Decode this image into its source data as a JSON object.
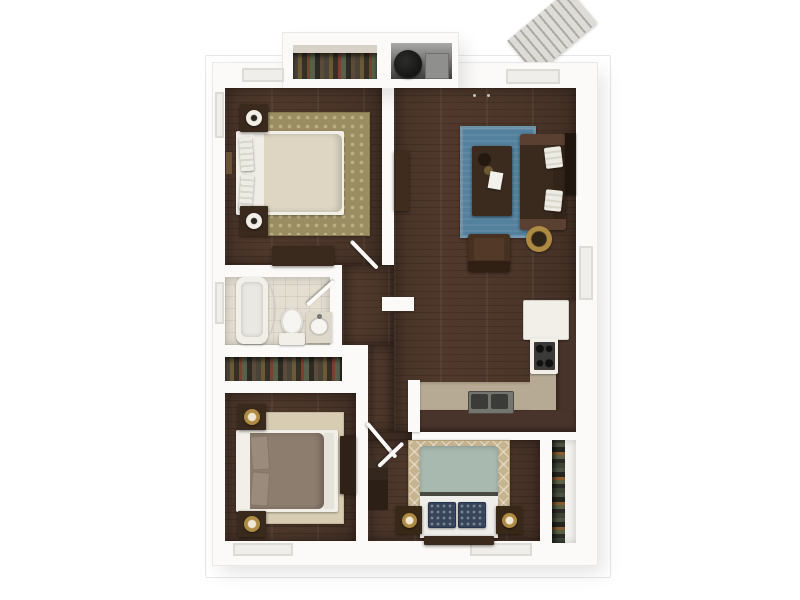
{
  "meta": {
    "type": "3d-floor-plan-rendering",
    "view": "top-down isometric",
    "visible_text": "none"
  },
  "palette": {
    "bg": "#ffffff",
    "wall": "#fbfaf8",
    "wood": "#50392c",
    "tile": "#e4ded1",
    "rugBlue": "#54819d",
    "rugOlive": "#9a8d61",
    "rugCream": "#d8cdb3",
    "rugTan": "#c6b48f",
    "duvetCream": "#ded6c3",
    "duvetTaupe": "#8d7d6e",
    "duvetSage": "#a8b9af",
    "pillowNavy": "#36455a",
    "furnDark": "#3a2a1d",
    "furnWhite": "#f1efe8",
    "lampCenter": "#2a2620",
    "counterTop": "#b7aa95",
    "counterBase": "#48342a",
    "steel": "#8f8f8d",
    "gold": "#ae8a42",
    "stairs": "#dedcd6",
    "glass": "#efeeea"
  },
  "rooms": [
    {
      "id": "bedroom-1",
      "label": "bedroom (top left)",
      "furniture": [
        "bed",
        "two nightstands with lamps",
        "dresser",
        "damask rug",
        "wall art"
      ]
    },
    {
      "id": "living-room",
      "label": "living room",
      "furniture": [
        "blue rug",
        "coffee table",
        "sofa with white pillows",
        "armchair",
        "round gold side table",
        "console",
        "wall tv"
      ]
    },
    {
      "id": "hallway",
      "label": "hallway",
      "furniture": []
    },
    {
      "id": "bathroom",
      "label": "bathroom",
      "furniture": [
        "bathtub with curtain",
        "toilet",
        "vanity sink"
      ]
    },
    {
      "id": "bedroom-2-closet",
      "label": "closet with hanging clothes",
      "furniture": []
    },
    {
      "id": "bedroom-2",
      "label": "bedroom (bottom left)",
      "furniture": [
        "bed",
        "two nightstands with lamps",
        "desk",
        "bookshelf",
        "cream rug"
      ]
    },
    {
      "id": "kitchen",
      "label": "kitchen",
      "furniture": [
        "refrigerator",
        "stove",
        "l-shaped counter",
        "double sink"
      ]
    },
    {
      "id": "bedroom-3",
      "label": "bedroom (bottom right)",
      "furniture": [
        "bed with navy pillows",
        "two nightstands with lamps",
        "trellis rug"
      ]
    },
    {
      "id": "bedroom-3-closet",
      "label": "closet with hanging clothes",
      "furniture": []
    },
    {
      "id": "entry-closet",
      "label": "wardrobe closet with hanging clothes",
      "furniture": []
    },
    {
      "id": "utility-closet",
      "label": "utility closet",
      "furniture": [
        "water heater",
        "electrical panel"
      ]
    },
    {
      "id": "stairs",
      "label": "exterior stairs",
      "furniture": []
    }
  ]
}
